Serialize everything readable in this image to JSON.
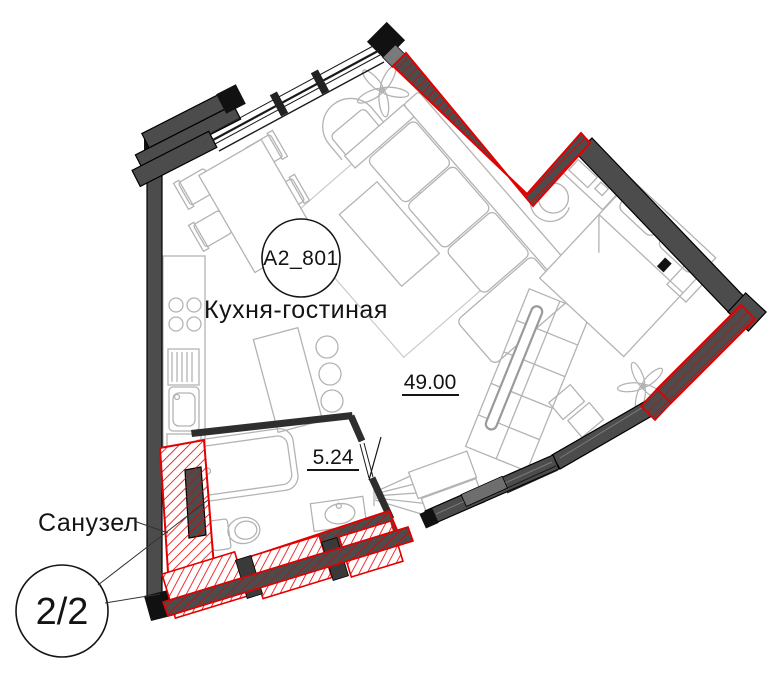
{
  "plan": {
    "unit_label": "A2_801",
    "rooms": [
      {
        "label": "Кухня-гостиная",
        "area": "49.00"
      },
      {
        "label": "Санузел",
        "area": "5.24"
      }
    ],
    "page_indicator": "2/2",
    "colors": {
      "background": "#ffffff",
      "wall_fill": "#4c4c4c",
      "wall_edge": "#000000",
      "renovation_red": "#e30000",
      "furniture_line": "#b3b3b3",
      "ink": "#141414"
    }
  }
}
